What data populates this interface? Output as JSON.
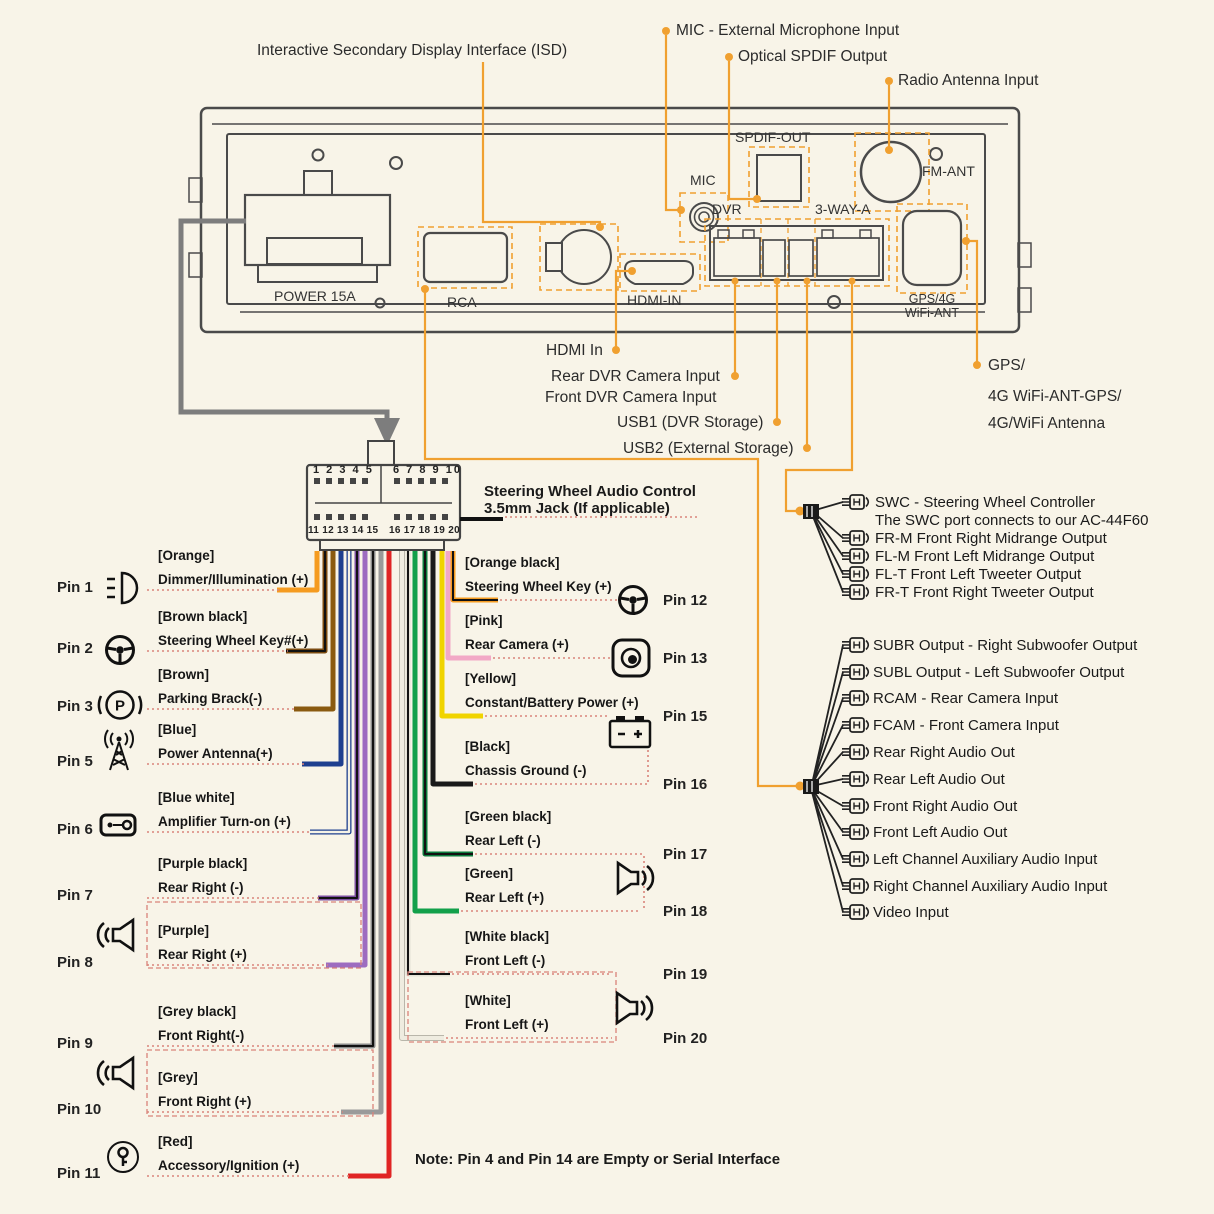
{
  "colors": {
    "accent_orange": "#f0a030",
    "leader_red_dotted": "#d9837a",
    "outline_gray": "#4a4a4a",
    "arrow_gray": "#7d7d7d",
    "background": "#f8f4e8"
  },
  "top_labels": {
    "isd": "Interactive Secondary Display Interface (ISD)",
    "mic": "MIC - External Microphone Input",
    "spdif": "Optical SPDIF Output",
    "radio": "Radio Antenna Input"
  },
  "unit_ports": {
    "power": "POWER 15A",
    "rca": "RCA",
    "hdmi": "HDMI-IN",
    "mic": "MIC",
    "spdif": "SPDIF-OUT",
    "dvr": "DVR",
    "three_way": "3-WAY-A",
    "fm": "FM-ANT",
    "gps_line1": "GPS/4G",
    "gps_line2": "WiFi-ANT"
  },
  "below_labels": {
    "hdmi_in": "HDMI In",
    "rear_dvr": "Rear DVR Camera Input",
    "front_dvr": "Front DVR Camera Input",
    "usb1": "USB1 (DVR Storage)",
    "usb2": "USB2 (External Storage)",
    "gps1": "GPS/",
    "gps2": "4G WiFi-ANT-GPS/",
    "gps3": "4G/WiFi Antenna"
  },
  "harness": {
    "r1l": "1 2 3 4 5",
    "r1r": "6 7 8 9 10",
    "r2l": "11 12 13 14 15",
    "r2r": "16 17 18 19 20",
    "title1": "Steering Wheel Audio Control",
    "title2": "3.5mm Jack (If applicable)"
  },
  "pins_left": [
    {
      "pin": "Pin 1",
      "color_label": "[Orange]",
      "function": "Dimmer/Illumination (+)",
      "wire": "#f59b20",
      "icon": "dimmer-illumination-icon"
    },
    {
      "pin": "Pin 2",
      "color_label": "[Brown black]",
      "function": "Steering Wheel Key#(+)",
      "wire": "#7a4a10",
      "icon": "steering-wheel-icon"
    },
    {
      "pin": "Pin 3",
      "color_label": "[Brown]",
      "function": "Parking Brack(-)",
      "wire": "#8a5a10",
      "icon": "parking-brake-icon"
    },
    {
      "pin": "Pin 5",
      "color_label": "[Blue]",
      "function": "Power Antenna(+)",
      "wire": "#1e3f8f",
      "icon": "antenna-icon"
    },
    {
      "pin": "Pin 6",
      "color_label": "[Blue white]",
      "function": "Amplifier Turn-on (+)",
      "wire": "#1e3f8f",
      "icon": "amplifier-icon"
    },
    {
      "pin": "Pin 7",
      "color_label": "[Purple black]",
      "function": "Rear Right (-)",
      "wire": "#7d4fa0",
      "icon": "speaker-icon"
    },
    {
      "pin": "Pin 8",
      "color_label": "[Purple]",
      "function": "Rear Right (+)",
      "wire": "#9d6cc0",
      "icon": "speaker-icon"
    },
    {
      "pin": "Pin 9",
      "color_label": "[Grey black]",
      "function": "Front Right(-)",
      "wire": "#8a8a8a",
      "icon": "speaker-icon"
    },
    {
      "pin": "Pin 10",
      "color_label": "[Grey]",
      "function": "Front Right (+)",
      "wire": "#9a9a9a",
      "icon": "speaker-icon"
    },
    {
      "pin": "Pin 11",
      "color_label": "[Red]",
      "function": "Accessory/Ignition (+)",
      "wire": "#e02424",
      "icon": "ignition-key-icon"
    }
  ],
  "pins_right": [
    {
      "pin": "Pin 12",
      "color_label": "[Orange black]",
      "function": "Steering Wheel Key (+)",
      "wire": "#f59b20",
      "icon": "steering-wheel-icon"
    },
    {
      "pin": "Pin 13",
      "color_label": "[Pink]",
      "function": "Rear Camera (+)",
      "wire": "#f2a8c6",
      "icon": "camera-icon"
    },
    {
      "pin": "Pin 15",
      "color_label": "[Yellow]",
      "function": "Constant/Battery Power (+)",
      "wire": "#f0d400",
      "icon": "battery-icon"
    },
    {
      "pin": "Pin 16",
      "color_label": "[Black]",
      "function": "Chassis Ground (-)",
      "wire": "#1a1a1a",
      "icon": "battery-icon"
    },
    {
      "pin": "Pin 17",
      "color_label": "[Green black]",
      "function": "Rear Left (-)",
      "wire": "#0c7a3c",
      "icon": "speaker-icon"
    },
    {
      "pin": "Pin 18",
      "color_label": "[Green]",
      "function": "Rear Left (+)",
      "wire": "#12a04a",
      "icon": "speaker-icon"
    },
    {
      "pin": "Pin 19",
      "color_label": "[White black]",
      "function": "Front Left (-)",
      "wire": "#e5e2d6",
      "icon": "speaker-icon"
    },
    {
      "pin": "Pin 20",
      "color_label": "[White]",
      "function": "Front Left (+)",
      "wire": "#efece0",
      "icon": "speaker-icon"
    }
  ],
  "swc_group": {
    "lines": [
      "SWC - Steering Wheel Controller",
      "The SWC port connects to our AC-44F60",
      "FR-M Front Right Midrange Output",
      "FL-M Front Left Midrange Output",
      "FL-T Front Left Tweeter Output",
      "FR-T Front Right Tweeter Output"
    ]
  },
  "rca_group": {
    "lines": [
      "SUBR Output - Right Subwoofer Output",
      "SUBL Output - Left Subwoofer Output",
      "RCAM - Rear Camera Input",
      "FCAM - Front Camera Input",
      "Rear Right Audio Out",
      "Rear Left Audio Out",
      "Front Right Audio Out",
      "Front Left Audio Out",
      "Left Channel Auxiliary Audio Input",
      "Right Channel Auxiliary Audio Input",
      "Video Input"
    ]
  },
  "note": "Note: Pin 4 and Pin 14 are Empty or Serial Interface",
  "icons": {
    "parking": "P"
  }
}
